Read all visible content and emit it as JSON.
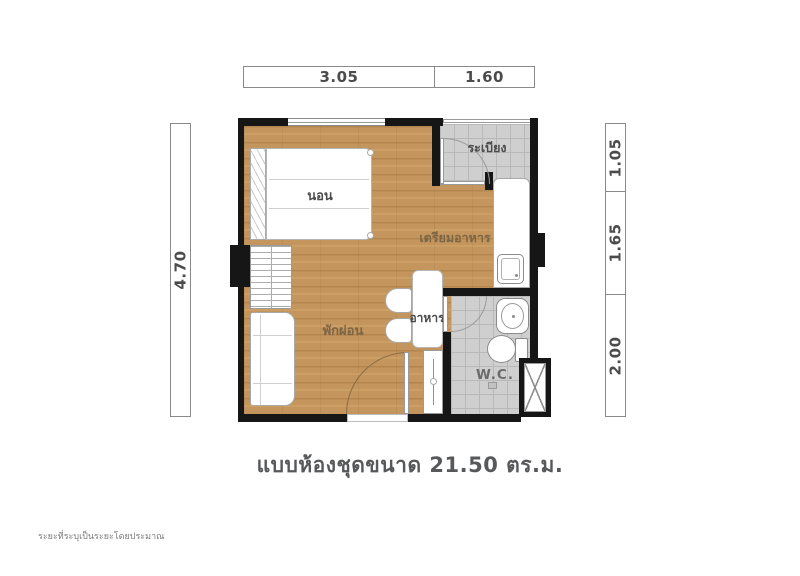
{
  "dims": {
    "top": [
      "3.05",
      "1.60"
    ],
    "left": [
      "4.70"
    ],
    "right": [
      "1.05",
      "1.65",
      "2.00"
    ]
  },
  "rooms": {
    "bedroom": "นอน",
    "balcony": "ระเบียง",
    "kitchen": "เตรียมอาหาร",
    "living": "พักผ่อน",
    "dining": "อาหาร",
    "wc": "W.C."
  },
  "caption": "แบบห้องชุดขนาด 21.50 ตร.ม.",
  "footnote": "ระยะที่ระบุเป็นระยะโดยประมาณ",
  "area_sqm": "21.50",
  "colors": {
    "wall": "#161616",
    "wood_floor": "#c4955c",
    "tile_floor": "#cfcfcf",
    "dim_text": "#4b4b4b"
  }
}
